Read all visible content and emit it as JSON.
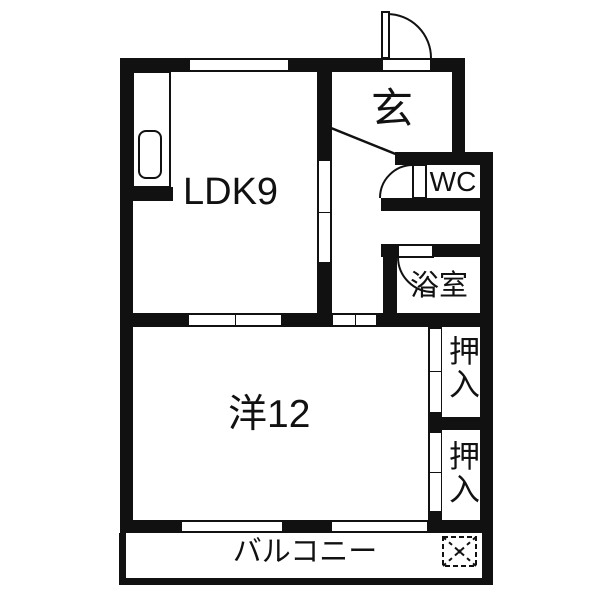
{
  "rooms": {
    "ldk": {
      "label": "LDK9"
    },
    "entrance": {
      "label": "玄"
    },
    "wc": {
      "label": "WC"
    },
    "bath": {
      "label": "浴室"
    },
    "western": {
      "label": "洋12"
    },
    "closet_upper": {
      "label": "押入"
    },
    "closet_lower": {
      "label": "押入"
    },
    "balcony": {
      "label": "バルコニー"
    }
  },
  "colors": {
    "wall": "#111111",
    "background": "#ffffff"
  }
}
